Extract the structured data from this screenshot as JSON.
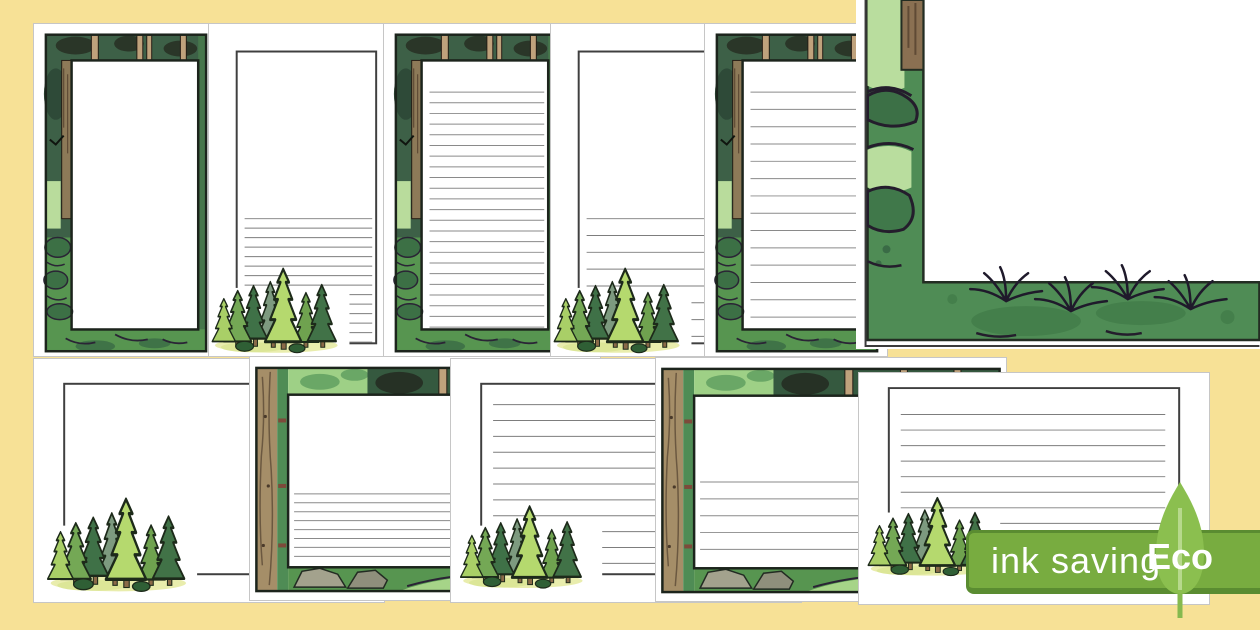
{
  "badge": {
    "ink_saving_label": "ink saving",
    "eco_label": "Eco",
    "banner_color": "#78ac40",
    "banner_border_color": "#5a8c31",
    "leaf_color": "#8bbf4f",
    "text_color": "#ffffff"
  },
  "background_color": "#f7e196",
  "artwork": {
    "theme": "forest / woodland page borders with pine trees",
    "palette": {
      "dark_forest_green": "#3d6047",
      "grass_green": "#579550",
      "mid_green": "#4f8c55",
      "light_green": "#b9dc9c",
      "tan_trunk": "#bfa27c",
      "brown_trunk": "#8d7a58",
      "outline_black": "#1c241c",
      "rule_line_gray": "#8a8a8a",
      "ink_saving_outline_gray": "#3f3f3f",
      "page_white": "#ffffff"
    },
    "pages": [
      {
        "position": "top-1",
        "orientation": "portrait",
        "style": "full forest border",
        "content": "blank"
      },
      {
        "position": "top-2",
        "orientation": "portrait",
        "style": "ink-saving outline with pine tree cluster",
        "content": "narrow ruled lines in lower half"
      },
      {
        "position": "top-3",
        "orientation": "portrait",
        "style": "full forest border",
        "content": "narrow ruled lines"
      },
      {
        "position": "top-4",
        "orientation": "portrait",
        "style": "ink-saving outline with pine tree cluster",
        "content": "wide ruled lines in lower half"
      },
      {
        "position": "top-5",
        "orientation": "portrait",
        "style": "full forest border",
        "content": "wide ruled lines"
      },
      {
        "position": "top-right",
        "orientation": "detail",
        "style": "enlarged corner of the forest border artwork",
        "content": "zoomed border detail"
      },
      {
        "position": "bottom-1",
        "orientation": "landscape",
        "style": "ink-saving outline with pine tree cluster",
        "content": "blank"
      },
      {
        "position": "bottom-2",
        "orientation": "landscape",
        "style": "full forest border",
        "content": "narrow ruled lines in lower half"
      },
      {
        "position": "bottom-3",
        "orientation": "landscape",
        "style": "ink-saving outline with pine tree cluster",
        "content": "ruled lines"
      },
      {
        "position": "bottom-4",
        "orientation": "landscape",
        "style": "full forest border",
        "content": "wide ruled lines in lower half"
      },
      {
        "position": "bottom-5",
        "orientation": "landscape",
        "style": "ink-saving outline with pine tree cluster",
        "content": "ruled lines"
      }
    ]
  }
}
